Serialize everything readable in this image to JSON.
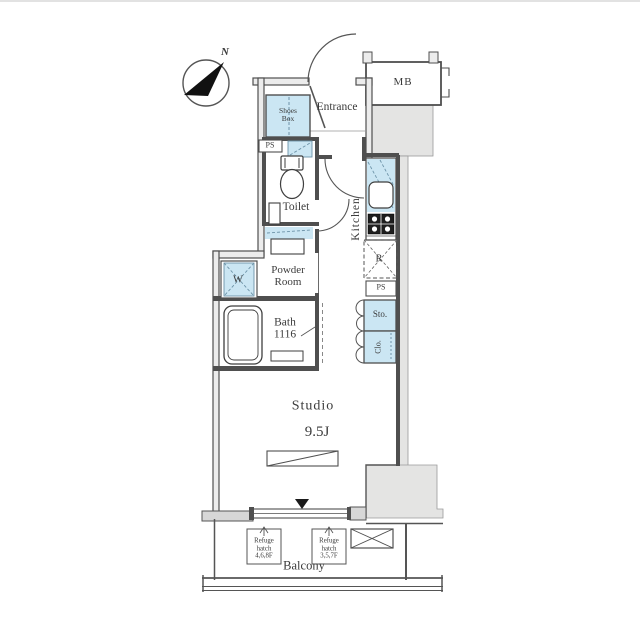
{
  "plan_title": "studio-apartment-floor-plan",
  "colors": {
    "fixture_blue": "#cbe6f3",
    "shaft_gray": "#e4e4e3",
    "wall_dark": "#4f4f4f",
    "text": "#3b3b3b"
  },
  "compass": {
    "north_label": "N"
  },
  "rooms": {
    "entrance": "Entrance",
    "shoes_box": "Shoes\nBox",
    "meter_box": "MB",
    "pipe_space_1": "PS",
    "toilet": "Toilet",
    "kitchen": "Kitchen",
    "powder_room": "Powder\nRoom",
    "washer": "W",
    "bath": "Bath\n1116",
    "refrigerator": "R",
    "pipe_space_2": "PS",
    "storage": "Sto.",
    "closet": "Clo.",
    "studio": "Studio",
    "studio_size": "9.5J",
    "balcony": "Balcony"
  },
  "balcony_items": {
    "refuge_hatch_1": "Refuge\nhatch\n4,6,8F",
    "refuge_hatch_2": "Refuge\nhatch\n3,5,7F"
  }
}
